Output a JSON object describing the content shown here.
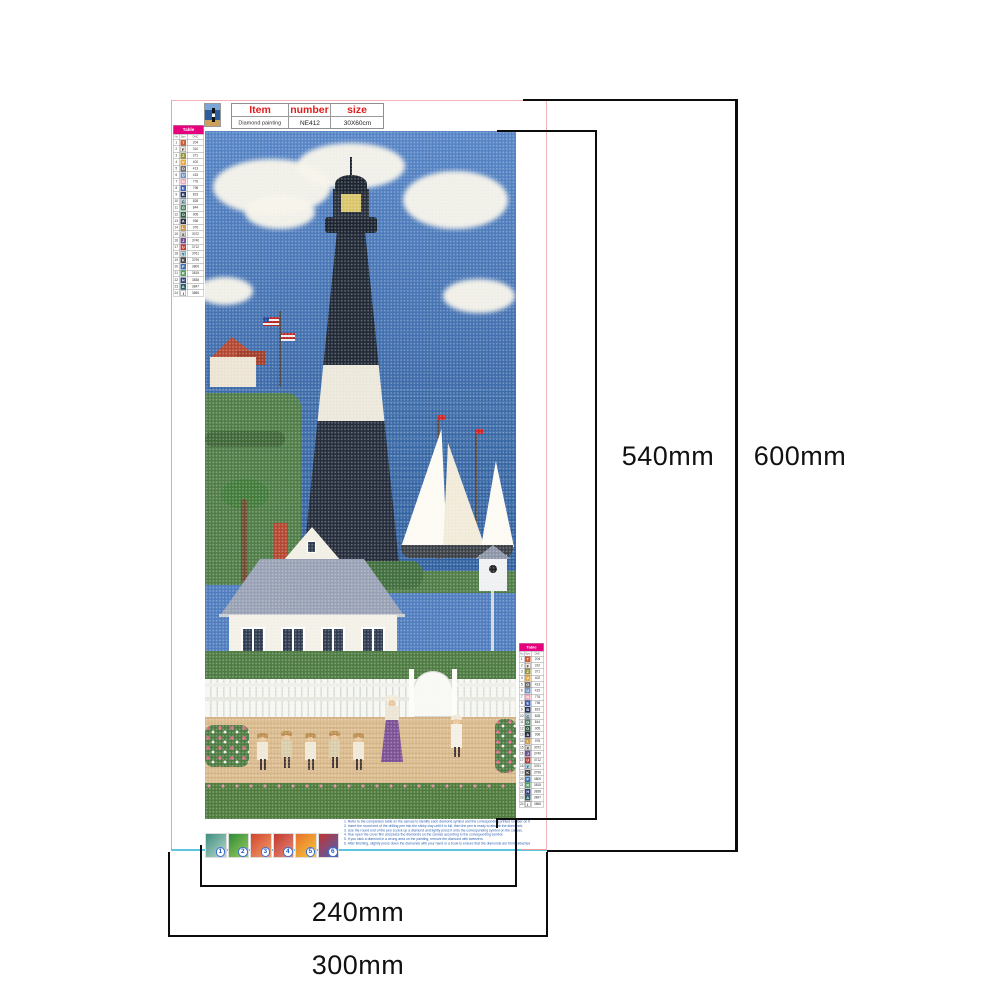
{
  "product": {
    "header": {
      "item": "Item",
      "number": "number",
      "size": "size"
    },
    "values": {
      "item": "Diamond painting",
      "number": "NE412",
      "size": "30X60cm"
    }
  },
  "dimensions": {
    "inner_height": "540mm",
    "outer_height": "600mm",
    "inner_width": "240mm",
    "outer_width": "300mm"
  },
  "legend": {
    "title": "Table",
    "subheaders": [
      "No",
      "Sym",
      "DMC"
    ],
    "rows": [
      {
        "num": "1",
        "sym": "T",
        "code": "204",
        "color": "#cf5a36",
        "light": false
      },
      {
        "num": "2",
        "sym": "F",
        "code": "310",
        "color": "#f3ede1",
        "light": true
      },
      {
        "num": "3",
        "sym": "Z",
        "code": "371",
        "color": "#96943e",
        "light": false
      },
      {
        "num": "4",
        "sym": "V",
        "code": "402",
        "color": "#e7a93f",
        "light": false
      },
      {
        "num": "5",
        "sym": "O",
        "code": "413",
        "color": "#6e6e6e",
        "light": false
      },
      {
        "num": "6",
        "sym": "U",
        "code": "415",
        "color": "#6f94c4",
        "light": false
      },
      {
        "num": "7",
        "sym": "N",
        "code": "776",
        "color": "#efa6b6",
        "light": false
      },
      {
        "num": "8",
        "sym": "E",
        "code": "798",
        "color": "#3a5cb0",
        "light": false
      },
      {
        "num": "9",
        "sym": "B",
        "code": "823",
        "color": "#24335f",
        "light": false
      },
      {
        "num": "10",
        "sym": "C",
        "code": "828",
        "color": "#abd4e6",
        "light": true
      },
      {
        "num": "11",
        "sym": "G",
        "code": "844",
        "color": "#4e7f68",
        "light": false
      },
      {
        "num": "12",
        "sym": "O",
        "code": "905",
        "color": "#2f6040",
        "light": false
      },
      {
        "num": "13",
        "sym": "A",
        "code": "936",
        "color": "#2b3046",
        "light": false
      },
      {
        "num": "14",
        "sym": "L",
        "code": "976",
        "color": "#cb9c4e",
        "light": false
      },
      {
        "num": "15",
        "sym": "X",
        "code": "3072",
        "color": "#dcdcd4",
        "light": true
      },
      {
        "num": "16",
        "sym": "J",
        "code": "3740",
        "color": "#6f5190",
        "light": false
      },
      {
        "num": "17",
        "sym": "U",
        "code": "3712",
        "color": "#c03a34",
        "light": false
      },
      {
        "num": "18",
        "sym": "Y",
        "code": "3761",
        "color": "#a9dae9",
        "light": true
      },
      {
        "num": "19",
        "sym": "K",
        "code": "3799",
        "color": "#454545",
        "light": false
      },
      {
        "num": "20",
        "sym": "P",
        "code": "3809",
        "color": "#3f70b2",
        "light": false
      },
      {
        "num": "21",
        "sym": "R",
        "code": "3815",
        "color": "#53a061",
        "light": false
      },
      {
        "num": "22",
        "sym": "H",
        "code": "3838",
        "color": "#323f7c",
        "light": false
      },
      {
        "num": "23",
        "sym": "A",
        "code": "3847",
        "color": "#2a5f63",
        "light": false
      },
      {
        "num": "24",
        "sym": "I",
        "code": "3865",
        "color": "#ffffff",
        "light": true
      }
    ]
  },
  "steps": [
    {
      "n": "1",
      "g1": "#3d8f7f",
      "g2": "#bcd8ce"
    },
    {
      "n": "2",
      "g1": "#2e8b3a",
      "g2": "#9ccd5a"
    },
    {
      "n": "3",
      "g1": "#d2452f",
      "g2": "#f0a06a"
    },
    {
      "n": "4",
      "g1": "#c03a2e",
      "g2": "#e98b7a"
    },
    {
      "n": "5",
      "g1": "#e8712c",
      "g2": "#f5c93a"
    },
    {
      "n": "6",
      "g1": "#c23333",
      "g2": "#4a62b8"
    }
  ],
  "instructions": [
    "1. Refer to the comparison table on the canvas to identify each diamond symbol and the corresponding printed number on the canvas.",
    "2. Insert the round end of the drilling pen into the sticky clay until it is full, then the pen is ready to absorb the diamonds.",
    "3. Use the round end of the pen to pick up a diamond and lightly press it onto the corresponding symbol on the canvas.",
    "4. Tear open the cover film and place the diamonds on the canvas according to the corresponding symbol.",
    "5. If you stick a diamond in a wrong area on the painting, remove the diamond with tweezers.",
    "6. After finishing, slightly press down the diamonds with your hand or a book to ensure that the diamonds are firmly attached."
  ],
  "colors": {
    "legend_header": "#e6007e",
    "item_header_red": "#e31c1c",
    "instruction_blue": "#2a5fb0",
    "canvas_edge_pink": "#f0b4b4",
    "canvas_edge_cyan": "#5cc6e0",
    "dimension_line": "#0c0c0c"
  }
}
